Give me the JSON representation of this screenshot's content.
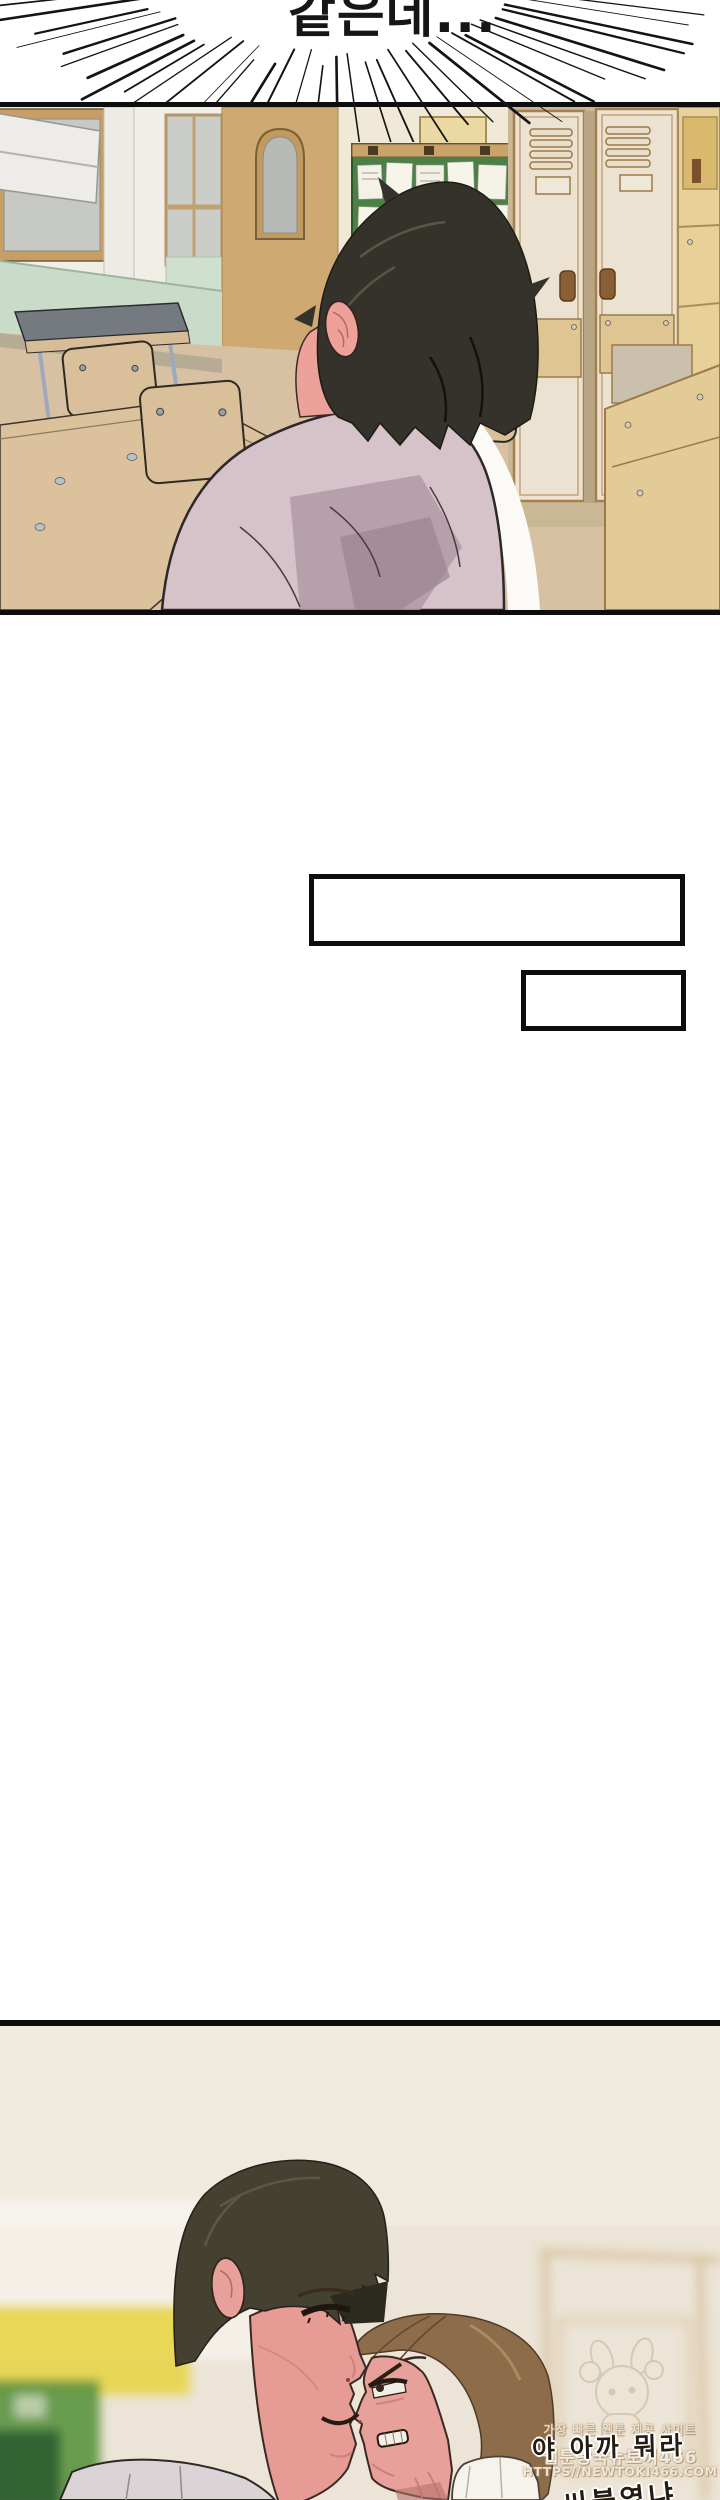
{
  "burst": {
    "text": "같은데..."
  },
  "panel2": {
    "dialogue_line1": "야 아까 뭐라",
    "dialogue_line2": "씨불였냐"
  },
  "watermark": {
    "tagline": "가장 빠른 웹툰 제공 사이트",
    "site": "웹툰왕국뉴토끼466",
    "url": "HTTPS//NEWTOKI466.COM"
  },
  "colors": {
    "panel_border": "#0d0d0d",
    "speedline_ink": "#141414",
    "classroom_wall": "#f1eee7",
    "classroom_wall_tan": "#cfa972",
    "wainscot_green": "#c9dcca",
    "board_green": "#47793d",
    "locker_cream": "#ebe2d1",
    "locker_trim": "#a5804e",
    "cabinet_yellow": "#e8d09b",
    "desk_tan": "#d6bc97",
    "desk_top_grey": "#747a80",
    "metal_leg": "#9fa9bd",
    "student_hair_black": "#34322a",
    "student_shirt_lavender": "#d6c2c9",
    "skin_pink": "#e8a29b",
    "aggressor_hair_olive": "#454130",
    "aggressor_shirt_grey": "#dad4d6",
    "victim_hair_brown": "#8d6c49",
    "victim_shirt_white": "#f6f3ec",
    "panel2_bg": "#ece4d6"
  }
}
